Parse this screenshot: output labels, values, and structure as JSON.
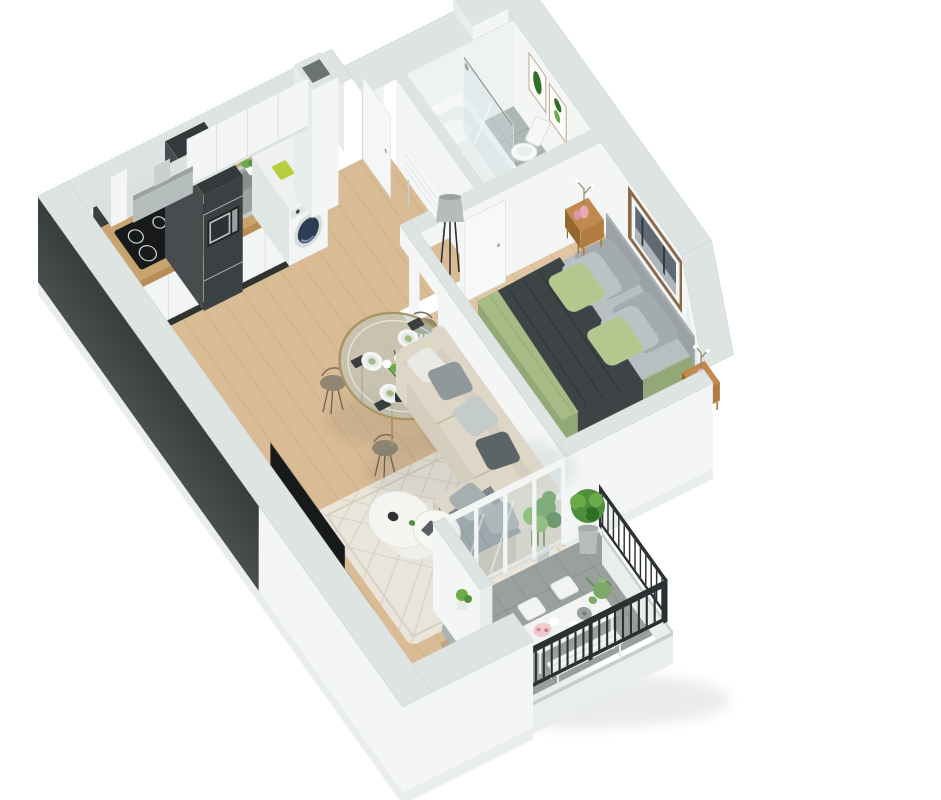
{
  "scene": {
    "label": "3D isometric cutaway floor plan render of a one-bedroom apartment with balcony",
    "rooms": [
      {
        "name": "kitchen",
        "furniture": [
          "upper-cabinets",
          "cooker-hood",
          "induction-hob",
          "sink",
          "tall-dark-unit",
          "microwave",
          "washing-machine",
          "duct-column",
          "counter"
        ]
      },
      {
        "name": "dining-area",
        "furniture": [
          "round-glass-table",
          "wire-chair",
          "wire-chair",
          "wire-chair",
          "wire-chair",
          "flower-centerpiece",
          "place-settings"
        ]
      },
      {
        "name": "living-room",
        "furniture": [
          "corner-sofa",
          "chaise",
          "scatter-pillows",
          "throw-blanket",
          "patterned-rug",
          "coffee-table",
          "pouf",
          "tv-console",
          "tv",
          "potted-plants"
        ]
      },
      {
        "name": "hallway",
        "furniture": [
          "entry-door",
          "slatted-console",
          "floor-lamp"
        ]
      },
      {
        "name": "bathroom",
        "furniture": [
          "bathtub",
          "shower-glass",
          "toilet",
          "sink-cabinet",
          "botanical-prints",
          "door"
        ]
      },
      {
        "name": "bedroom",
        "furniture": [
          "double-bed",
          "headboard",
          "green-duvet",
          "dark-throw",
          "pillows",
          "nightstand",
          "nightstand",
          "pink-vases",
          "framed-art",
          "dark-desk",
          "door",
          "juliet-glass"
        ]
      },
      {
        "name": "balcony",
        "furniture": [
          "metal-railing",
          "dining-table",
          "bench",
          "folding-chairs",
          "boxwood-plant",
          "watering-can",
          "tea-set"
        ]
      }
    ]
  },
  "palette": {
    "wallTop": "#dde4e1",
    "wallFace": "#f3f6f5",
    "wallShade": "#e7edeb",
    "wallInner": "#eef2f0",
    "wallDark": "#4a4f4e",
    "wallDark2": "#383d3c",
    "slab": "#e9edec",
    "floorWood": "#d9bb95",
    "plank": "#c8a87e",
    "bedroomWood": "#e0c6a2",
    "tile": "#aeb8b3",
    "tileLine": "#99a39d",
    "balconyFloor": "#9aa09d",
    "balconyLine": "#878d8a",
    "railing": "#2b3032",
    "glass": "#cfe0e6",
    "glassFrame": "#f2f5f4",
    "counterWood": "#c9a46f",
    "counterEdge": "#b98d55",
    "cabinet": "#f3f6f5",
    "cabinetShade": "#e0e6e4",
    "cabinetLine": "#d3dad7",
    "kick": "#2f3332",
    "unitDark": "#3b4042",
    "unitSide": "#474c4e",
    "steel": "#c2c9c9",
    "steelDark": "#9aa2a2",
    "cooktop": "#17191b",
    "washerDoor": "#2e3d56",
    "lime": "#b9ce3c",
    "rug": "#e9e5db",
    "rugLine": "#d5cec0",
    "sofa": "#d5cdbd",
    "sofaLight": "#ded6c7",
    "sofaShade": "#c3b9a7",
    "throw": "#7e8689",
    "pillowGray": "#8f999b",
    "pillowLight": "#c3cbcb",
    "pillowDark": "#5b6467",
    "pillowWhite": "#e8e8e4",
    "tv": "#17191a",
    "consoleWood": "#c29a66",
    "consoleWoodDark": "#ad8654",
    "pouf": "#aab3b1",
    "poufLight": "#bcc5c2",
    "brass": "#a99562",
    "bronze": "#8f8774",
    "tableGlass": "#b9c8c2",
    "bedGray": "#b8bfc1",
    "bedGreen": "#a6bb86",
    "bedGreenDark": "#93a877",
    "blanket": "#3e4346",
    "headboard": "#9aa2a5",
    "bedPillowGray": "#a3abae",
    "bedPillowLight": "#bac2c4",
    "bedPillowGreen": "#b2c88f",
    "nightWood": "#b07c42",
    "nightWoodDark": "#96682f",
    "artFrame": "#8a6a4a",
    "artPhoto": "#5f6a72",
    "plant": "#4e8f3c",
    "plantLight": "#6cab49",
    "plantDark": "#2f6f26",
    "pot": "#b9bdb9",
    "pink": "#e6a9b6"
  }
}
